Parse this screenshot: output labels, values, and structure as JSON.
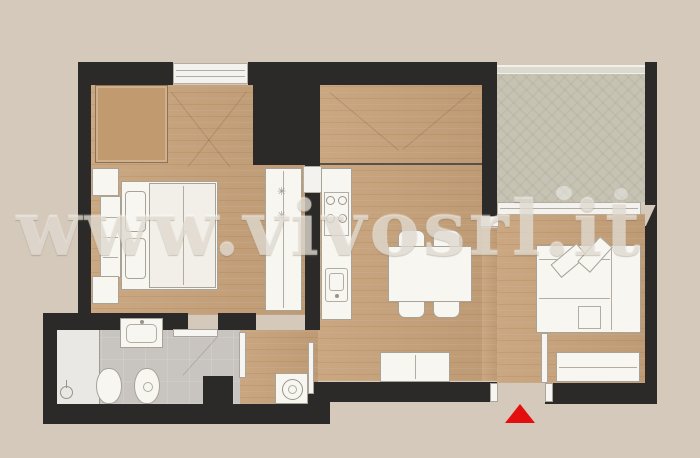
{
  "watermark": {
    "text": "www.vivosrl.it"
  },
  "palette": {
    "bg": "#d5c9bb",
    "wall": "#2b2a28",
    "wood": "#c8a37b",
    "woodunit": "#c19a6f",
    "terrace": "#c6c3b3",
    "bath": "#c8c4c0",
    "shower": "#eae8e4",
    "furn": "#f7f6f1",
    "line": "#a9a296",
    "accent": "#e30f0f"
  },
  "plan": {
    "type": "apartment-floor-plan",
    "rooms": [
      {
        "name": "bedroom",
        "features": [
          "double-bed",
          "headboard",
          "nightstand",
          "nightstand",
          "wardrobe",
          "tall-wardrobe"
        ]
      },
      {
        "name": "kitchen-dining",
        "features": [
          "kitchen-counter",
          "stove-4-burners",
          "sink",
          "dining-table",
          "4-chairs",
          "cabinet"
        ]
      },
      {
        "name": "living-room",
        "features": [
          "corner-sofa",
          "pouf",
          "sideboard"
        ]
      },
      {
        "name": "bathroom",
        "features": [
          "shower",
          "washbasin",
          "toilet",
          "bidet",
          "towel-stand"
        ]
      },
      {
        "name": "hallway",
        "features": [
          "washing-machine"
        ]
      },
      {
        "name": "terrace",
        "features": [
          "railing",
          "sliding-door"
        ]
      }
    ],
    "entrance_marker": "red-triangle-arrow"
  }
}
